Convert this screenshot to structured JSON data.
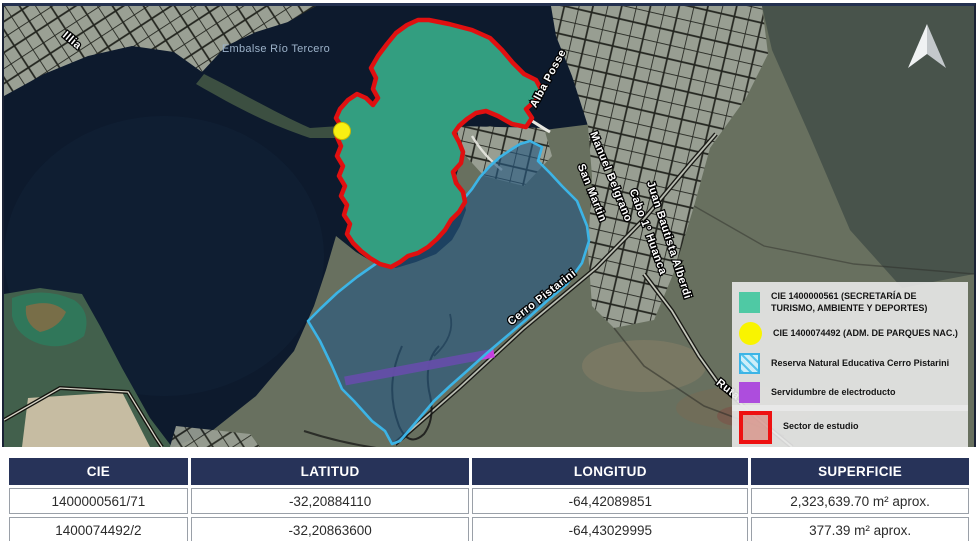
{
  "map": {
    "water_name": "Embalse Río Tercero",
    "labels": [
      {
        "text": "Illia"
      },
      {
        "text": "Alba Posse"
      },
      {
        "text": "Manuel Belgrano"
      },
      {
        "text": "San Martin"
      },
      {
        "text": "Cabo 1º Huanca"
      },
      {
        "text": "Juan Bautista Alberdi"
      },
      {
        "text": "Cerro Pistarini"
      },
      {
        "text": "Ruta"
      }
    ],
    "legend": {
      "items": [
        {
          "swatch": "teal-square",
          "color": "#4fc9a4",
          "label": "CIE 1400000561 (SECRETARÍA DE TURISMO, AMBIENTE Y DEPORTES)"
        },
        {
          "swatch": "yellow-circle",
          "color": "#f9f400",
          "label": "CIE 1400074492 (ADM. DE PARQUES NAC.)"
        },
        {
          "swatch": "blue-hatch",
          "color": "#3cb4e6",
          "label": "Reserva Natural Educativa Cerro Pistarini"
        },
        {
          "swatch": "purple-square",
          "color": "#ad4ddd",
          "label": "Servidumbre de electroducto"
        }
      ],
      "sector_item": {
        "swatch": "red-outline",
        "color": "#ee1111",
        "label": "Sector de estudio"
      }
    },
    "overlay_colors": {
      "study_outline": "#e01010",
      "cie_green_fill": "#339e80",
      "reserve_hatch": "#56c3ee",
      "servidumbre": "#cb3fe8",
      "parques_dot": "#f8ef12"
    }
  },
  "table": {
    "columns": [
      "CIE",
      "LATITUD",
      "LONGITUD",
      "SUPERFICIE"
    ],
    "rows": [
      [
        "1400000561/71",
        "-32,20884110",
        "-64,42089851",
        "2,323,639.70 m² aprox."
      ],
      [
        "1400074492/2",
        "-32,20863600",
        "-64,43029995",
        "377.39 m² aprox."
      ]
    ],
    "header_bg": "#273359"
  }
}
